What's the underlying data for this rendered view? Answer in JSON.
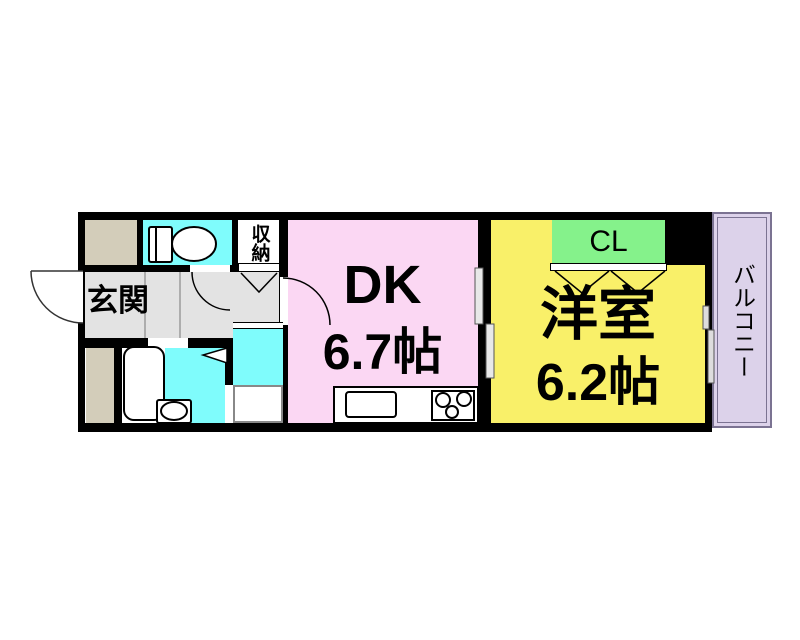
{
  "floorplan": {
    "type": "apartment-floor-plan",
    "rooms": {
      "entrance": {
        "label": "玄関"
      },
      "storage": {
        "label": "収納"
      },
      "dk": {
        "label": "DK",
        "size": "6.7帖"
      },
      "western": {
        "label": "洋室",
        "size": "6.2帖"
      },
      "closet": {
        "label": "CL"
      },
      "balcony": {
        "label": "バルコニー"
      }
    },
    "fixtures": [
      "toilet-fixture",
      "bathtub-fixture",
      "washbasin-fixture",
      "kitchen-sink",
      "stove-burners",
      "washing-machine-pan",
      "entrance-door-swing",
      "toilet-door-swing",
      "dk-door-swing",
      "storage-folding-door",
      "closet-folding-doors",
      "washroom-folding-door",
      "sliding-door",
      "balcony-window"
    ],
    "colors": {
      "wall": "#000000",
      "dk": "#fbd7f3",
      "western_room": "#f9f069",
      "closet": "#85f28b",
      "wet_area": "#7ffcfc",
      "balcony": "#dcd2ea",
      "hallway": "#e3e3e3",
      "shaft": "#d3cdba",
      "fixture": "#ffffff"
    }
  }
}
